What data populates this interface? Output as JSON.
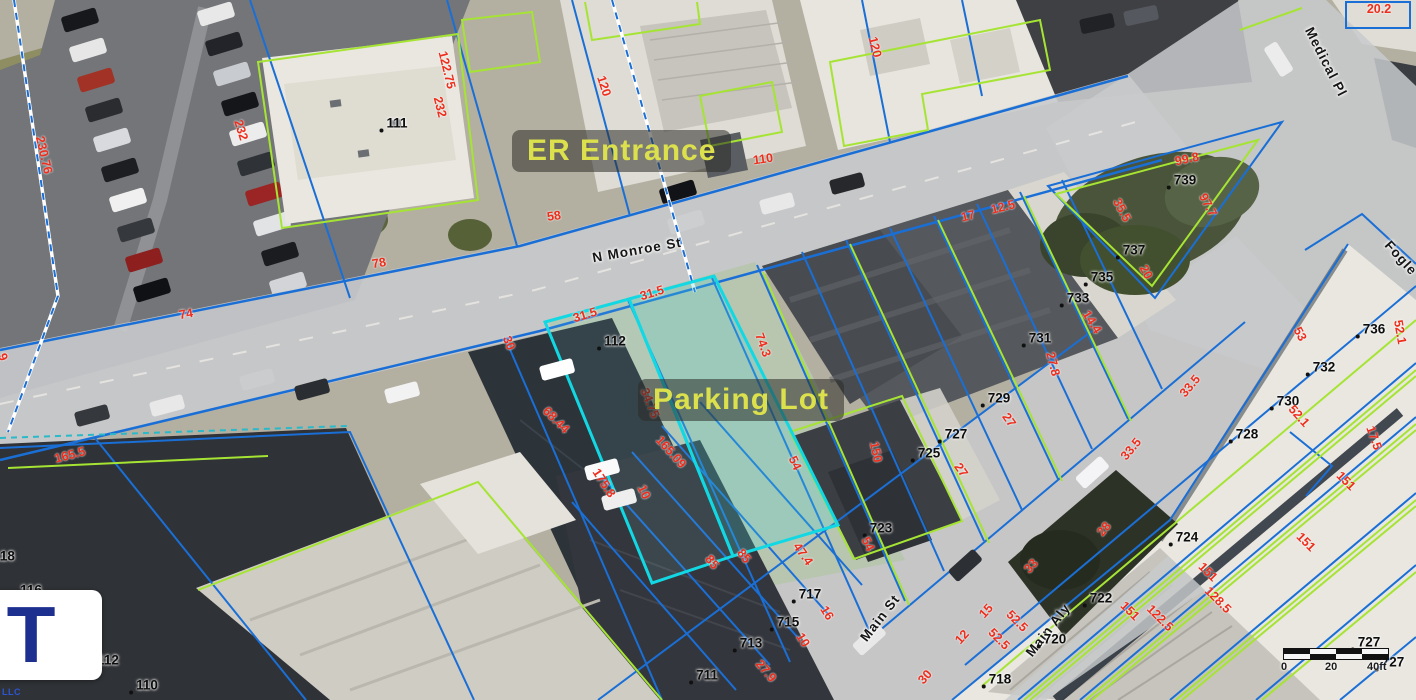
{
  "map": {
    "annotations": [
      {
        "label": "ER Entrance",
        "x": 512,
        "y": 130
      },
      {
        "label": "Parking Lot",
        "x": 638,
        "y": 379
      }
    ],
    "streets": [
      {
        "label": "N  Monroe St",
        "x": 637,
        "y": 250,
        "rot": -10
      },
      {
        "label": "Main St",
        "x": 880,
        "y": 618,
        "rot": -52
      },
      {
        "label": "Main Aly",
        "x": 1048,
        "y": 630,
        "rot": -52
      },
      {
        "label": "Medical Pl",
        "x": 1326,
        "y": 62,
        "rot": 63
      },
      {
        "label": "Fogle",
        "x": 1401,
        "y": 258,
        "rot": 48
      }
    ],
    "parcel_labels": [
      {
        "n": "111",
        "x": 397,
        "y": 123
      },
      {
        "n": "112",
        "x": 615,
        "y": 341
      },
      {
        "n": "739",
        "x": 1185,
        "y": 180
      },
      {
        "n": "737",
        "x": 1134,
        "y": 250
      },
      {
        "n": "735",
        "x": 1102,
        "y": 277
      },
      {
        "n": "733",
        "x": 1078,
        "y": 298
      },
      {
        "n": "731",
        "x": 1040,
        "y": 338
      },
      {
        "n": "729",
        "x": 999,
        "y": 398
      },
      {
        "n": "727",
        "x": 956,
        "y": 434
      },
      {
        "n": "725",
        "x": 929,
        "y": 453
      },
      {
        "n": "723",
        "x": 881,
        "y": 528
      },
      {
        "n": "717",
        "x": 810,
        "y": 594
      },
      {
        "n": "715",
        "x": 788,
        "y": 622
      },
      {
        "n": "713",
        "x": 751,
        "y": 643
      },
      {
        "n": "711",
        "x": 707,
        "y": 675
      },
      {
        "n": "736",
        "x": 1374,
        "y": 329
      },
      {
        "n": "732",
        "x": 1324,
        "y": 367
      },
      {
        "n": "730",
        "x": 1288,
        "y": 401
      },
      {
        "n": "728",
        "x": 1247,
        "y": 434
      },
      {
        "n": "724",
        "x": 1187,
        "y": 537
      },
      {
        "n": "722",
        "x": 1101,
        "y": 598
      },
      {
        "n": "720",
        "x": 1055,
        "y": 639
      },
      {
        "n": "718",
        "x": 1000,
        "y": 679
      },
      {
        "n": "727",
        "x": 1369,
        "y": 642
      },
      {
        "n": "727",
        "x": 1393,
        "y": 662
      },
      {
        "n": "118",
        "x": 4,
        "y": 556
      },
      {
        "n": "116",
        "x": 31,
        "y": 590
      },
      {
        "n": "114",
        "x": 82,
        "y": 635
      },
      {
        "n": "112",
        "x": 108,
        "y": 660
      },
      {
        "n": "110",
        "x": 147,
        "y": 685
      }
    ],
    "dimension_labels": [
      {
        "v": "230.76",
        "x": 44,
        "y": 155,
        "rot": 77
      },
      {
        "v": "232",
        "x": 241,
        "y": 130,
        "rot": 73
      },
      {
        "v": "122.75",
        "x": 447,
        "y": 70,
        "rot": 76
      },
      {
        "v": "232",
        "x": 440,
        "y": 107,
        "rot": 76
      },
      {
        "v": "120",
        "x": 604,
        "y": 86,
        "rot": 72
      },
      {
        "v": "58",
        "x": 554,
        "y": 216,
        "rot": -8
      },
      {
        "v": "110",
        "x": 763,
        "y": 159,
        "rot": -8
      },
      {
        "v": "120",
        "x": 875,
        "y": 47,
        "rot": 76
      },
      {
        "v": "20.2",
        "x": 1379,
        "y": 9,
        "rot": 0
      },
      {
        "v": "78",
        "x": 379,
        "y": 263,
        "rot": -10
      },
      {
        "v": "74",
        "x": 186,
        "y": 314,
        "rot": -10
      },
      {
        "v": "9",
        "x": 3,
        "y": 357,
        "rot": 70
      },
      {
        "v": "30",
        "x": 509,
        "y": 343,
        "rot": 68
      },
      {
        "v": "31.5",
        "x": 585,
        "y": 315,
        "rot": -17
      },
      {
        "v": "31.5",
        "x": 652,
        "y": 293,
        "rot": -17
      },
      {
        "v": "74.3",
        "x": 763,
        "y": 345,
        "rot": 70
      },
      {
        "v": "68.44",
        "x": 556,
        "y": 420,
        "rot": 45
      },
      {
        "v": "34.75",
        "x": 650,
        "y": 403,
        "rot": 68
      },
      {
        "v": "175.8",
        "x": 604,
        "y": 483,
        "rot": 57
      },
      {
        "v": "10",
        "x": 644,
        "y": 492,
        "rot": 65
      },
      {
        "v": "165.09",
        "x": 671,
        "y": 452,
        "rot": 48
      },
      {
        "v": "54",
        "x": 795,
        "y": 463,
        "rot": 65
      },
      {
        "v": "150",
        "x": 876,
        "y": 452,
        "rot": 78
      },
      {
        "v": "54",
        "x": 868,
        "y": 544,
        "rot": 65
      },
      {
        "v": "47.4",
        "x": 803,
        "y": 554,
        "rot": 55
      },
      {
        "v": "85",
        "x": 712,
        "y": 562,
        "rot": 50
      },
      {
        "v": "85",
        "x": 744,
        "y": 556,
        "rot": 50
      },
      {
        "v": "16",
        "x": 827,
        "y": 613,
        "rot": 58
      },
      {
        "v": "10",
        "x": 803,
        "y": 640,
        "rot": 58
      },
      {
        "v": "27.9",
        "x": 766,
        "y": 671,
        "rot": 50
      },
      {
        "v": "17",
        "x": 968,
        "y": 216,
        "rot": -14
      },
      {
        "v": "12.5",
        "x": 1003,
        "y": 207,
        "rot": -14
      },
      {
        "v": "35.5",
        "x": 1122,
        "y": 210,
        "rot": 62
      },
      {
        "v": "99.8",
        "x": 1187,
        "y": 159,
        "rot": -12
      },
      {
        "v": "97.7",
        "x": 1208,
        "y": 205,
        "rot": 62
      },
      {
        "v": "20",
        "x": 1146,
        "y": 272,
        "rot": 62
      },
      {
        "v": "14.4",
        "x": 1092,
        "y": 322,
        "rot": 58
      },
      {
        "v": "27.8",
        "x": 1053,
        "y": 364,
        "rot": 76
      },
      {
        "v": "27",
        "x": 1009,
        "y": 420,
        "rot": 55
      },
      {
        "v": "27",
        "x": 961,
        "y": 470,
        "rot": 55
      },
      {
        "v": "33.5",
        "x": 1190,
        "y": 386,
        "rot": -50
      },
      {
        "v": "33.5",
        "x": 1131,
        "y": 449,
        "rot": -50
      },
      {
        "v": "53",
        "x": 1300,
        "y": 334,
        "rot": 62
      },
      {
        "v": "52.1",
        "x": 1299,
        "y": 416,
        "rot": 48
      },
      {
        "v": "52.1",
        "x": 1400,
        "y": 332,
        "rot": 80
      },
      {
        "v": "17.5",
        "x": 1374,
        "y": 438,
        "rot": 70
      },
      {
        "v": "28",
        "x": 1104,
        "y": 529,
        "rot": -50
      },
      {
        "v": "33",
        "x": 1031,
        "y": 566,
        "rot": -48
      },
      {
        "v": "30",
        "x": 925,
        "y": 677,
        "rot": -48
      },
      {
        "v": "12",
        "x": 962,
        "y": 637,
        "rot": -48
      },
      {
        "v": "15",
        "x": 986,
        "y": 611,
        "rot": -48
      },
      {
        "v": "52.5",
        "x": 1017,
        "y": 621,
        "rot": 45
      },
      {
        "v": "52.5",
        "x": 999,
        "y": 639,
        "rot": 45
      },
      {
        "v": "151",
        "x": 1346,
        "y": 481,
        "rot": 45
      },
      {
        "v": "151",
        "x": 1306,
        "y": 542,
        "rot": 45
      },
      {
        "v": "151",
        "x": 1208,
        "y": 572,
        "rot": 45
      },
      {
        "v": "151",
        "x": 1130,
        "y": 611,
        "rot": 45
      },
      {
        "v": "128.5",
        "x": 1218,
        "y": 600,
        "rot": 45
      },
      {
        "v": "122.5",
        "x": 1160,
        "y": 618,
        "rot": 45
      },
      {
        "v": "165.5",
        "x": 70,
        "y": 455,
        "rot": -15
      }
    ],
    "scale_bar": {
      "ticks": [
        "0",
        "20",
        "40ft"
      ]
    },
    "logo": {
      "letter": "T",
      "subtext": "LLC"
    },
    "colors": {
      "parcel_line_blue": "#1a6fd6",
      "parcel_line_green": "#a6e434",
      "highlight_cyan": "#12d8e4",
      "dimension_red": "#ee2d1c",
      "annotation_yellow": "#dbe04c"
    }
  }
}
